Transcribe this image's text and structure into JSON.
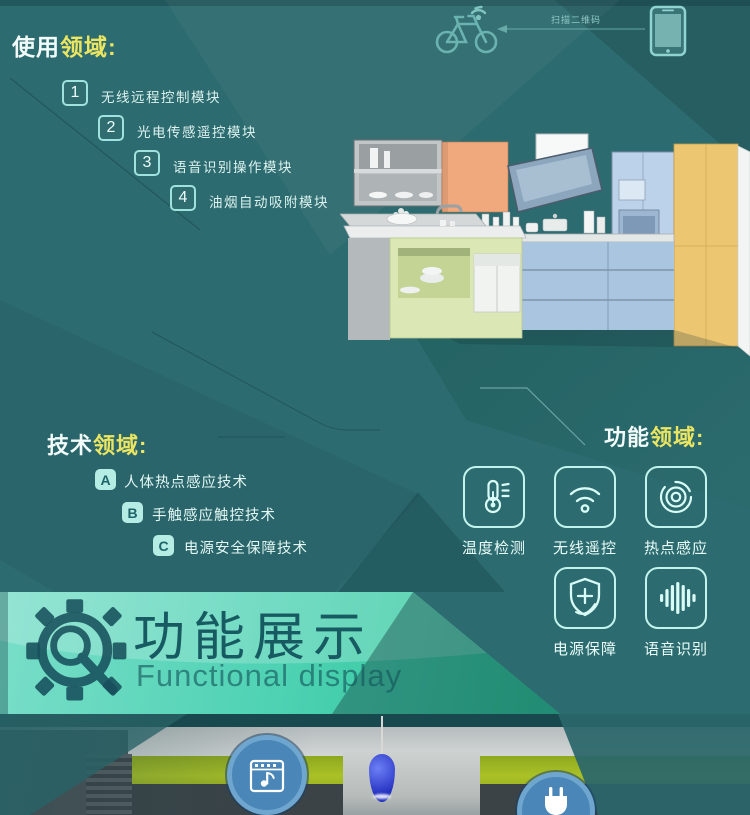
{
  "page": {
    "bg_color": "#2c6b6f",
    "accent_color": "#aeeee6",
    "highlight_color": "#ece561"
  },
  "scan_row": {
    "label": "扫描二维码"
  },
  "usage": {
    "title_prefix": "使用",
    "title_highlight": "领域:",
    "items": [
      {
        "num": "1",
        "label": "无线远程控制模块"
      },
      {
        "num": "2",
        "label": "光电传感遥控模块"
      },
      {
        "num": "3",
        "label": "语音识别操作模块"
      },
      {
        "num": "4",
        "label": "油烟自动吸附模块"
      }
    ]
  },
  "tech": {
    "title_prefix": "技术",
    "title_highlight": "领域:",
    "items": [
      {
        "key": "A",
        "label": "人体热点感应技术"
      },
      {
        "key": "B",
        "label": "手触感应触控技术"
      },
      {
        "key": "C",
        "label": "电源安全保障技术"
      }
    ]
  },
  "functions": {
    "title_prefix": "功能",
    "title_highlight": "领域:",
    "items": [
      {
        "icon": "thermometer-icon",
        "label": "温度检测"
      },
      {
        "icon": "wifi-icon",
        "label": "无线遥控"
      },
      {
        "icon": "hotspot-icon",
        "label": "热点感应"
      },
      {
        "icon": "shield-plus-icon",
        "label": "电源保障"
      },
      {
        "icon": "voice-wave-icon",
        "label": "语音识别"
      }
    ]
  },
  "banner": {
    "title": "功能展示",
    "subtitle": "Functional display"
  },
  "photo": {
    "badge_color": "#4a87b8"
  }
}
